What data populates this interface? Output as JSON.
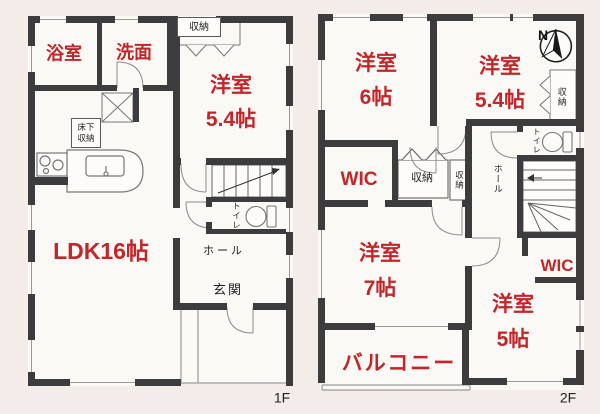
{
  "colors": {
    "wall": "#3c3b3d",
    "room_text_red": "#c2262a",
    "text_black": "#1f1f1f",
    "paper": "#fbf9f6",
    "background": "#f3ece8",
    "thin_line": "#8a8a8a"
  },
  "floor1": {
    "floor_label": "1F",
    "labels": {
      "bath": "浴室",
      "washroom": "洗面",
      "closet_top": "収納",
      "western_room_name": "洋室",
      "western_room_size": "5.4帖",
      "underfloor_storage_line1": "床下",
      "underfloor_storage_line2": "収納",
      "ldk": "LDK16帖",
      "toilet": "トイレ",
      "hall": "ホール",
      "entrance": "玄関"
    }
  },
  "floor2": {
    "floor_label": "2F",
    "compass_north": "N",
    "labels": {
      "room6_name": "洋室",
      "room6_size": "6帖",
      "room54_name": "洋室",
      "room54_size": "5.4帖",
      "closet_right": "収納",
      "wic_left": "WIC",
      "closet_mid": "収納",
      "closet_mid_small": "収納",
      "toilet": "トイレ",
      "hall": "ホール",
      "room7_name": "洋室",
      "room7_size": "7帖",
      "balcony": "バルコニー",
      "wic_right": "WIC",
      "room5_name": "洋室",
      "room5_size": "5帖"
    }
  }
}
